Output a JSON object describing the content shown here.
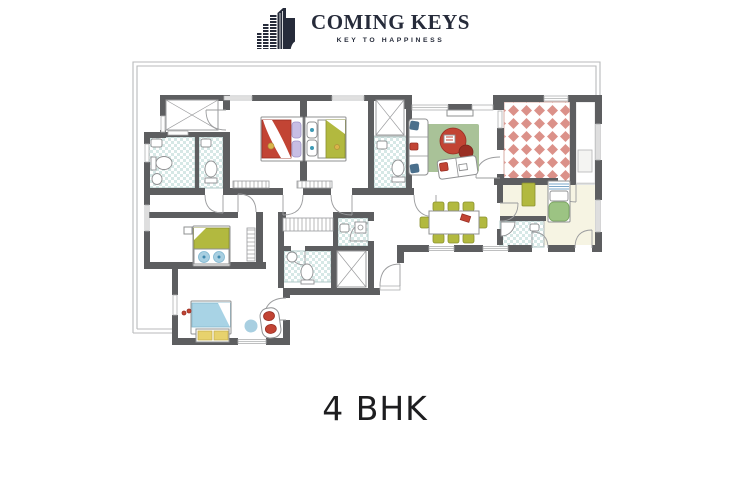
{
  "brand": {
    "name": "COMING KEYS",
    "tagline": "KEY TO HAPPINESS"
  },
  "plan": {
    "title": "4 BHK"
  },
  "colors": {
    "logo": "#262b3a",
    "title_color": "#1d1d1f",
    "wall": "#5d5e60",
    "frame": "#b8babb",
    "window_line": "#aeb0b1",
    "door_line": "#9b9c9e",
    "outline": "#8f9092",
    "outline2": "#9a9b9d",
    "tile": "#d6e8e6",
    "tile_border": "#a9c5c2",
    "terrace": "#db9189",
    "terrace_border": "#d7aca6",
    "rug": "#a9c298",
    "olive": "#b2b93f",
    "olive_dark": "#8a912f",
    "red": "#c24434",
    "red_dark": "#992f24",
    "blue_bed": "#a8d3e5",
    "lavender": "#c7bee4",
    "cyan_dot": "#3e9ab5",
    "green_bed": "#9cc383",
    "green_dark": "#76a35c",
    "cream": "#f6f4e3",
    "yellow": "#e7d26d",
    "blue_rug": "#a8cfe1",
    "navy_pillow": "#4a6f8c"
  }
}
